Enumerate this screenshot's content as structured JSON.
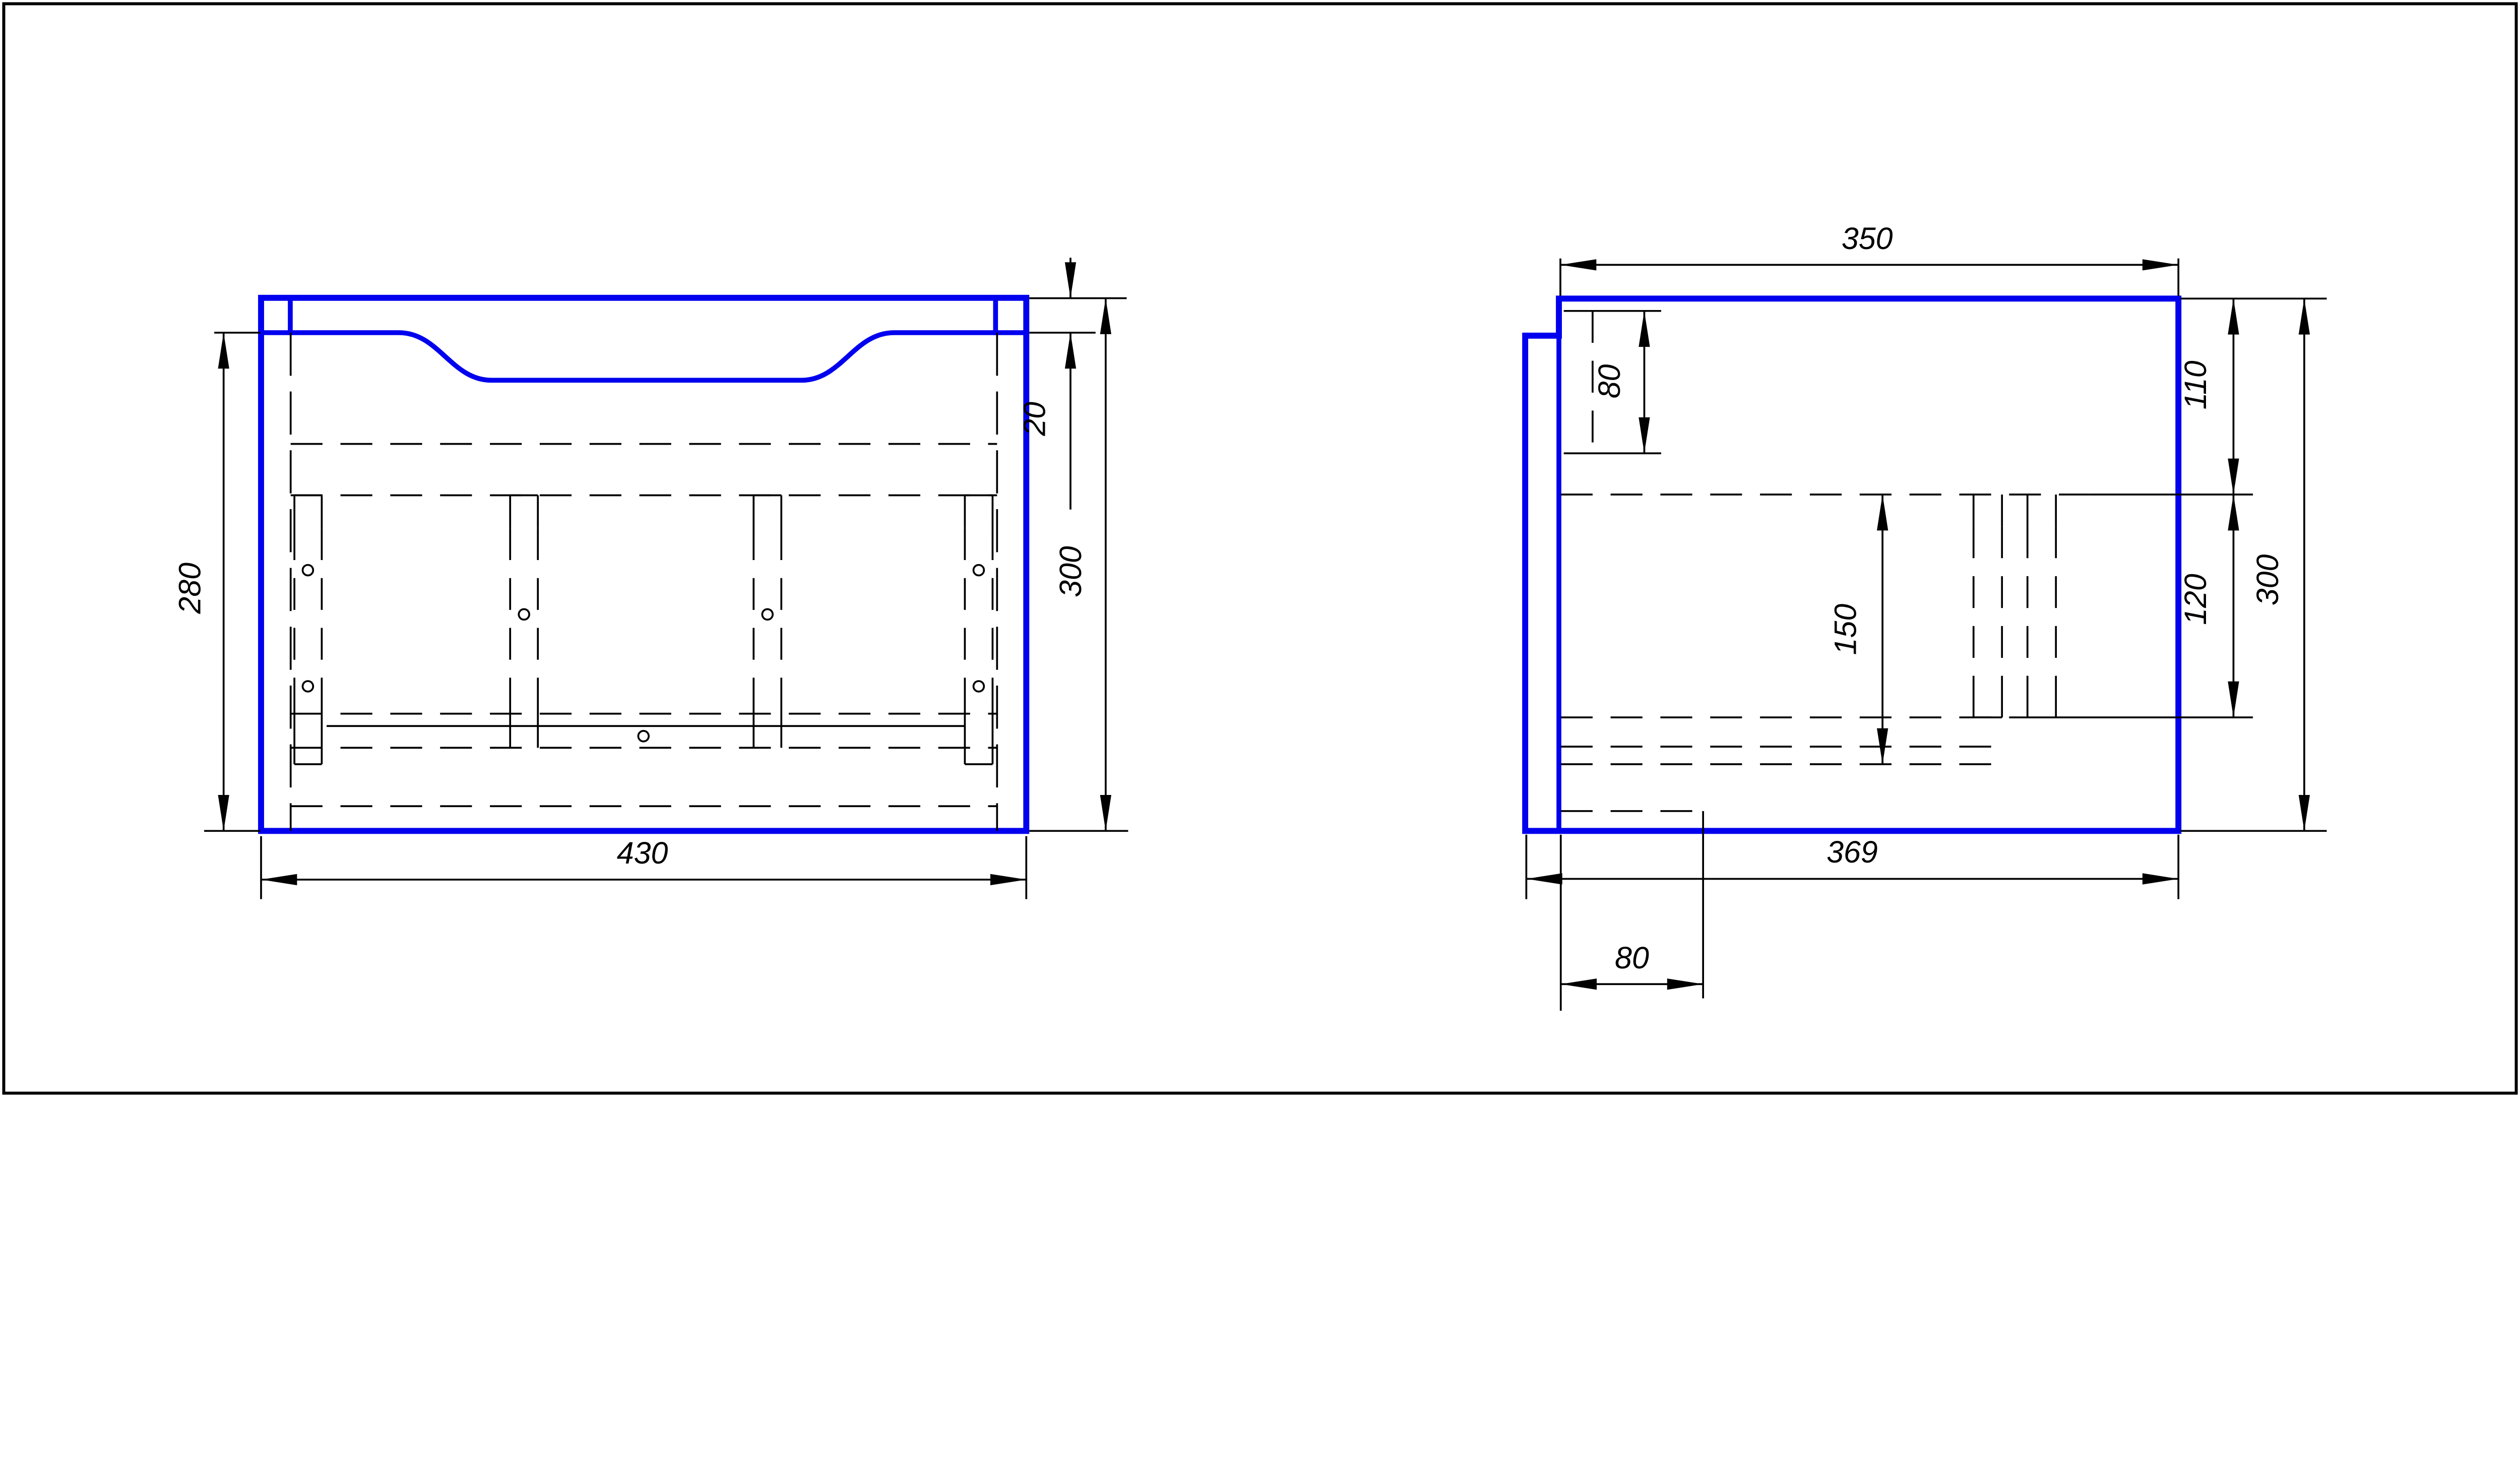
{
  "colors": {
    "background": "#ffffff",
    "outline_blue": "#0000ee",
    "line_black": "#000000"
  },
  "front_view": {
    "width_label": "430",
    "inner_height_label": "280",
    "top_band_label": "20",
    "height_label": "300"
  },
  "side_view": {
    "top_width_label": "350",
    "top_offset_label": "80",
    "upper_height_label": "110",
    "middle_height_label": "120",
    "inner_height_label": "150",
    "height_label": "300",
    "bottom_width_label": "369",
    "bottom_offset_label": "80"
  }
}
